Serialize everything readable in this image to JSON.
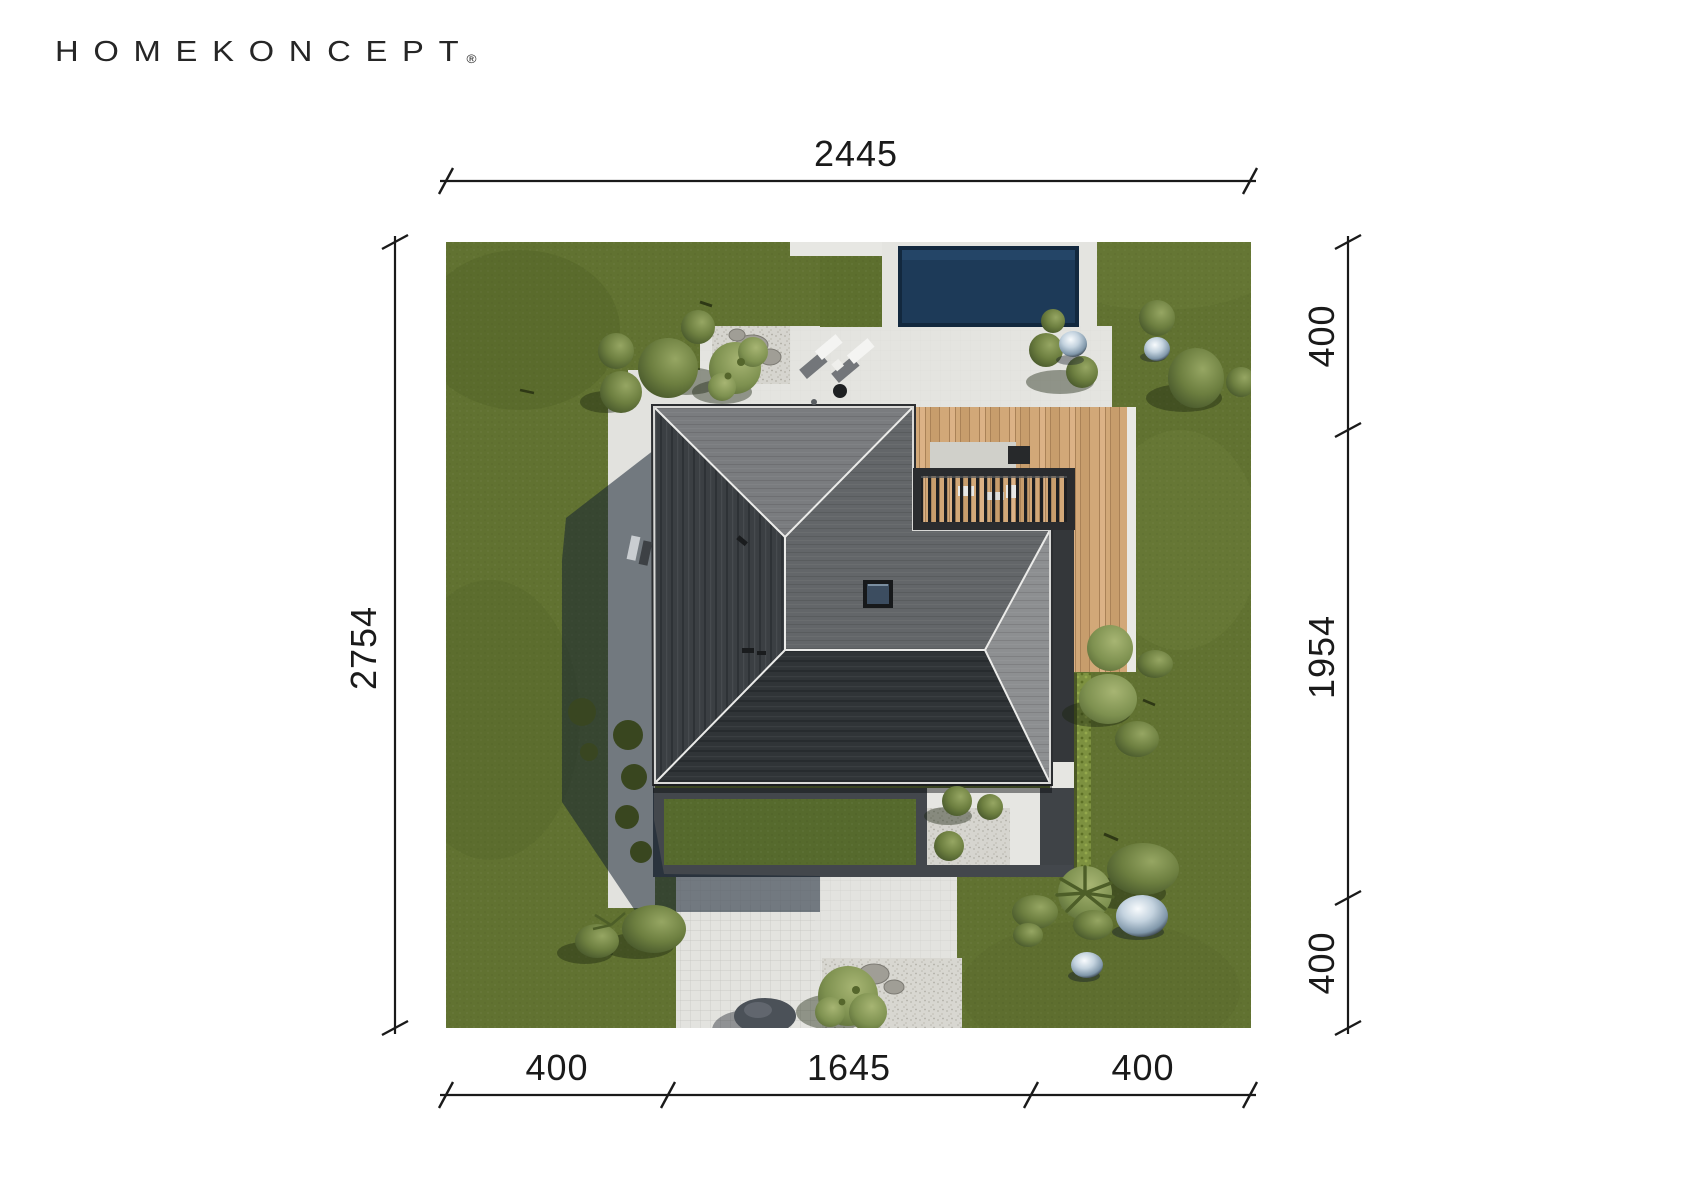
{
  "brand": {
    "logo_text": "HOMEKONCEPT",
    "registered_mark": "®"
  },
  "dimensions": {
    "top_total": "2445",
    "left_total": "2754",
    "right_segments": [
      "400",
      "1954",
      "400"
    ],
    "bottom_segments": [
      "400",
      "1645",
      "400"
    ]
  },
  "site_plan": {
    "features": [
      "lawn",
      "swimming-pool",
      "paved-patio",
      "gravel-bed",
      "wooden-terrace",
      "pergola",
      "hip-roof-house",
      "skylight",
      "courtyard-frame",
      "garden-path",
      "hedge",
      "shrubs",
      "ornamental-spheres",
      "sun-loungers",
      "house-shadow"
    ],
    "colors": {
      "lawn": "#617231",
      "paving": "#e4e4e0",
      "gravel": "#d6d5cf",
      "pool": "#1d3a58",
      "deck": "#d2a878",
      "roof_dark": "#3b3f43",
      "roof_mid": "#636669",
      "roof_light": "#7a7c7f",
      "frame_dark": "#43474c",
      "hedge": "#7d9140",
      "shadow": "#16222e"
    }
  }
}
